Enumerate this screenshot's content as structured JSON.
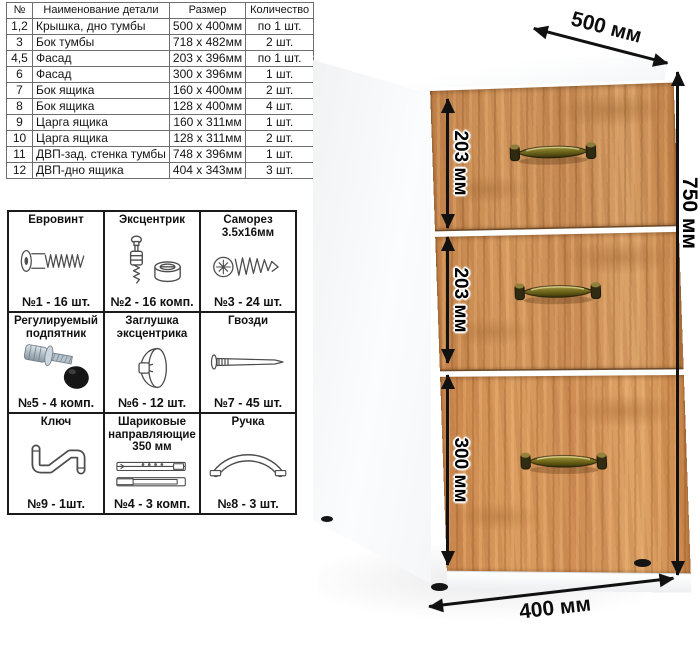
{
  "parts_table": {
    "headers": [
      "№",
      "Наименование детали",
      "Размер",
      "Количество"
    ],
    "rows": [
      {
        "num": "1,2",
        "name": "Крышка, дно тумбы",
        "size": "500 х 400мм",
        "qty": "по 1 шт."
      },
      {
        "num": "3",
        "name": "Бок тумбы",
        "size": "718 х 482мм",
        "qty": "2 шт."
      },
      {
        "num": "4,5",
        "name": "Фасад",
        "size": "203 х 396мм",
        "qty": "по 1 шт."
      },
      {
        "num": "6",
        "name": "Фасад",
        "size": "300 х 396мм",
        "qty": "1 шт."
      },
      {
        "num": "7",
        "name": "Бок ящика",
        "size": "160 х 400мм",
        "qty": "2 шт."
      },
      {
        "num": "8",
        "name": "Бок ящика",
        "size": "128 х 400мм",
        "qty": "4 шт."
      },
      {
        "num": "9",
        "name": "Царга ящика",
        "size": "160 х 311мм",
        "qty": "1 шт."
      },
      {
        "num": "10",
        "name": "Царга ящика",
        "size": "128 х 311мм",
        "qty": "2 шт."
      },
      {
        "num": "11",
        "name": "ДВП-зад. стенка тумбы",
        "size": "748 х 396мм",
        "qty": "1 шт."
      },
      {
        "num": "12",
        "name": "ДВП-дно ящика",
        "size": "404 х 343мм",
        "qty": "3 шт."
      }
    ]
  },
  "hardware": {
    "items": [
      {
        "name": "Евровинт",
        "count": "№1 - 16 шт.",
        "icon": "euro-screw"
      },
      {
        "name": "Эксцентрик",
        "count": "№2 - 16 комп.",
        "icon": "cam-lock"
      },
      {
        "name": "Саморез 3.5х16мм",
        "count": "№3 - 24 шт.",
        "icon": "self-tapping-screw"
      },
      {
        "name": "Регулируемый подпятник",
        "count": "№5 - 4 комп.",
        "icon": "adjustable-foot"
      },
      {
        "name": "Заглушка эксцентрика",
        "count": "№6 - 12 шт.",
        "icon": "cam-cover"
      },
      {
        "name": "Гвозди",
        "count": "№7 - 45 шт.",
        "icon": "nail"
      },
      {
        "name": "Ключ",
        "count": "№9 - 1шт.",
        "icon": "hex-key"
      },
      {
        "name": "Шариковые направляющие 350 мм",
        "count": "№4 - 3 комп.",
        "icon": "ball-slides"
      },
      {
        "name": "Ручка",
        "count": "№8 - 3 шт.",
        "icon": "handle"
      }
    ]
  },
  "cabinet": {
    "drawer_count": 3,
    "dims": {
      "depth": "500 мм",
      "height": "750 мм",
      "drawer1": "203 мм",
      "drawer2": "203 мм",
      "drawer3": "300 мм",
      "width": "400 мм"
    }
  },
  "colors": {
    "wood": "#c98a52",
    "wood_dark": "#a86f3e",
    "handle_brass": "#6d641f",
    "cabinet_body": "#ffffff",
    "dimension_arrow": "#111111"
  }
}
